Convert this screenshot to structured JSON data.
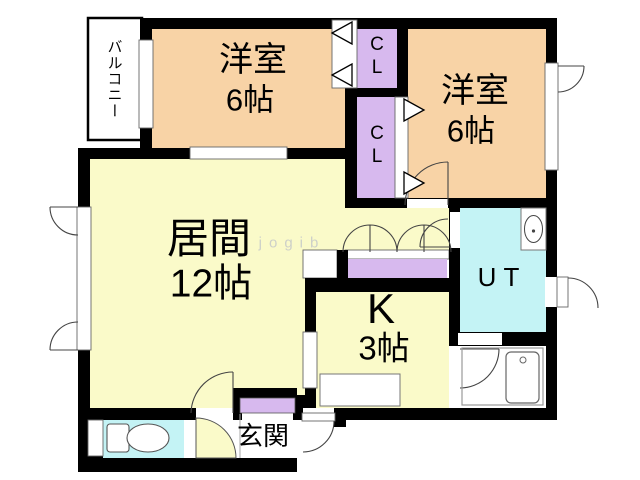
{
  "floorplan": {
    "colors": {
      "wall": "#000000",
      "room_peach": "#f8d3a6",
      "room_yellow": "#fafac9",
      "closet_purple": "#d7b9ee",
      "wet_cyan": "#c4f3f5",
      "floor_white": "#ffffff"
    },
    "watermark": "jogib",
    "rooms": {
      "balcony": {
        "label": "バルコニー"
      },
      "bedroom1": {
        "label": "洋室",
        "size": "6帖"
      },
      "bedroom2": {
        "label": "洋室",
        "size": "6帖"
      },
      "living": {
        "label": "居間",
        "size": "12帖"
      },
      "kitchen": {
        "label": "K",
        "size": "3帖"
      },
      "utility": {
        "label": "UT"
      },
      "closet_upper": {
        "label": "CL"
      },
      "closet_lower": {
        "label": "CL"
      },
      "entrance": {
        "label": "玄関"
      }
    }
  }
}
